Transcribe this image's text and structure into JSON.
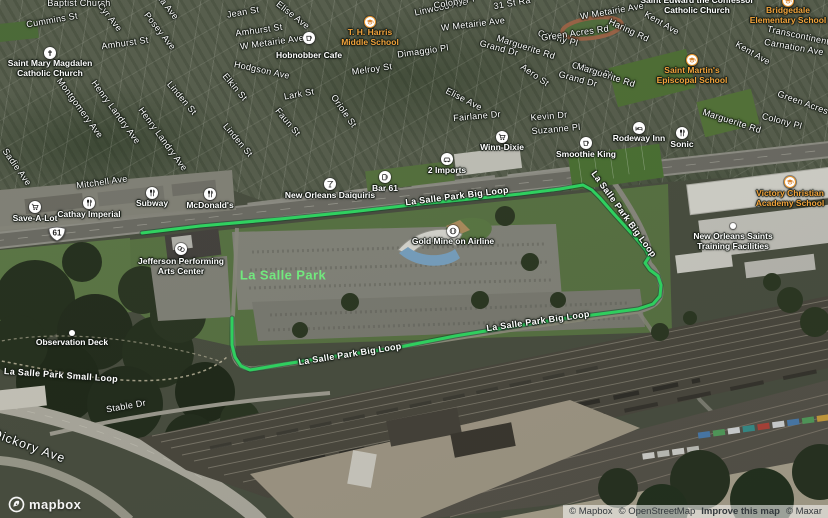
{
  "colors": {
    "route": "#2fe065",
    "park_label": "#72e87e",
    "school_label": "#f2a33c",
    "street_label": "#ffffff"
  },
  "shield": {
    "route_number": "61",
    "x": 57,
    "y": 234
  },
  "park_label": {
    "text": "La Salle Park",
    "x": 283,
    "y": 275
  },
  "logo": {
    "text": "mapbox"
  },
  "attribution": {
    "items": [
      "© Mapbox",
      "© OpenStreetMap",
      "Improve this map",
      "© Maxar"
    ]
  },
  "route": {
    "name": "La Salle Park Big Loop",
    "points": "142,233 200,226 280,219 350,212 420,204 470,199 520,194 560,189 583,185 592,190 600,198 614,214 634,236 646,250 649,257 645,263 650,270 658,276 661,285 660,296 653,304 638,309 600,314 560,319 510,327 455,336 395,348 330,357 285,364 262,368 250,370 241,366 235,357 232,345 232,318"
  },
  "route_labels": [
    {
      "text": "La Salle Park Big Loop",
      "x": 457,
      "y": 196,
      "rot": -7
    },
    {
      "text": "La Salle Park Big Loop",
      "x": 624,
      "y": 214,
      "rot": 54
    },
    {
      "text": "La Salle Park Big Loop",
      "x": 350,
      "y": 354,
      "rot": -9
    },
    {
      "text": "La Salle Park Big Loop",
      "x": 538,
      "y": 321,
      "rot": -8
    },
    {
      "text": "La Salle Park Small Loop",
      "x": 61,
      "y": 375,
      "rot": 4
    }
  ],
  "street_labels": [
    {
      "text": "Baptist Church",
      "x": 79,
      "y": 3,
      "rot": 0
    },
    {
      "text": "Cummins St",
      "x": 52,
      "y": 20,
      "rot": -10
    },
    {
      "text": "ma Ave",
      "x": 167,
      "y": 6,
      "rot": 52
    },
    {
      "text": "Cyr Ave",
      "x": 110,
      "y": 17,
      "rot": 52
    },
    {
      "text": "Posey Ave",
      "x": 160,
      "y": 31,
      "rot": 52
    },
    {
      "text": "Jean St",
      "x": 243,
      "y": 12,
      "rot": -10
    },
    {
      "text": "Amhurst St",
      "x": 125,
      "y": 43,
      "rot": -8
    },
    {
      "text": "Amhurst St",
      "x": 259,
      "y": 30,
      "rot": -8
    },
    {
      "text": "W Metairie Ave",
      "x": 272,
      "y": 42,
      "rot": -8
    },
    {
      "text": "W Metairie Ave",
      "x": 473,
      "y": 24,
      "rot": -7
    },
    {
      "text": "W Metairie Ave",
      "x": 612,
      "y": 11,
      "rot": -10
    },
    {
      "text": "31 St Ra",
      "x": 512,
      "y": 3,
      "rot": -10
    },
    {
      "text": "Elise Ave",
      "x": 293,
      "y": 15,
      "rot": 38
    },
    {
      "text": "Elise Ave",
      "x": 464,
      "y": 99,
      "rot": 27
    },
    {
      "text": "Hodgson Ave",
      "x": 262,
      "y": 70,
      "rot": 12
    },
    {
      "text": "Henry Landry Ave",
      "x": 116,
      "y": 112,
      "rot": 54
    },
    {
      "text": "Henry Landry Ave",
      "x": 163,
      "y": 139,
      "rot": 54
    },
    {
      "text": "Montgomery Ave",
      "x": 80,
      "y": 108,
      "rot": 54
    },
    {
      "text": "Linden St",
      "x": 182,
      "y": 98,
      "rot": 50
    },
    {
      "text": "Linden St",
      "x": 238,
      "y": 140,
      "rot": 50
    },
    {
      "text": "Elkin St",
      "x": 235,
      "y": 87,
      "rot": 50
    },
    {
      "text": "Faun St",
      "x": 288,
      "y": 122,
      "rot": 50
    },
    {
      "text": "Sadie Ave",
      "x": 17,
      "y": 167,
      "rot": 55
    },
    {
      "text": "Mitchell Ave",
      "x": 102,
      "y": 182,
      "rot": -8
    },
    {
      "text": "Lark St",
      "x": 299,
      "y": 94,
      "rot": -10
    },
    {
      "text": "Oriole St",
      "x": 344,
      "y": 111,
      "rot": 55
    },
    {
      "text": "Melroy St",
      "x": 372,
      "y": 69,
      "rot": -8
    },
    {
      "text": "Dimaggio Pl",
      "x": 423,
      "y": 51,
      "rot": -8
    },
    {
      "text": "Linwood Ave",
      "x": 441,
      "y": 7,
      "rot": -12
    },
    {
      "text": "Colony Pl",
      "x": 454,
      "y": 2,
      "rot": -10
    },
    {
      "text": "Colony Pl",
      "x": 558,
      "y": 38,
      "rot": 15
    },
    {
      "text": "Colony Pl",
      "x": 592,
      "y": 70,
      "rot": 15
    },
    {
      "text": "Colony Pl",
      "x": 782,
      "y": 121,
      "rot": 15
    },
    {
      "text": "Marguerite Rd",
      "x": 526,
      "y": 47,
      "rot": 18
    },
    {
      "text": "Marguerite Rd",
      "x": 606,
      "y": 75,
      "rot": 18
    },
    {
      "text": "Marguerite Rd",
      "x": 732,
      "y": 121,
      "rot": 18
    },
    {
      "text": "Grand Dr",
      "x": 499,
      "y": 48,
      "rot": 15
    },
    {
      "text": "Grand Dr",
      "x": 578,
      "y": 79,
      "rot": 15
    },
    {
      "text": "Aero St",
      "x": 535,
      "y": 75,
      "rot": 35
    },
    {
      "text": "Green Acres Rd",
      "x": 575,
      "y": 33,
      "rot": -8
    },
    {
      "text": "Green Acres Rd",
      "x": 810,
      "y": 105,
      "rot": 20
    },
    {
      "text": "Transcontinental",
      "x": 802,
      "y": 36,
      "rot": 12
    },
    {
      "text": "Carnation Ave",
      "x": 794,
      "y": 47,
      "rot": 10
    },
    {
      "text": "Kent Ave",
      "x": 662,
      "y": 23,
      "rot": 30
    },
    {
      "text": "Kent Ave",
      "x": 753,
      "y": 53,
      "rot": 30
    },
    {
      "text": "Haring Rd",
      "x": 629,
      "y": 30,
      "rot": 25
    },
    {
      "text": "Fairlane Dr",
      "x": 477,
      "y": 116,
      "rot": -5
    },
    {
      "text": "Kevin Dr",
      "x": 549,
      "y": 116,
      "rot": -5
    },
    {
      "text": "Suzanne Pl",
      "x": 556,
      "y": 129,
      "rot": -5
    },
    {
      "text": "Stable Dr",
      "x": 126,
      "y": 406,
      "rot": -10
    },
    {
      "text": "Dickory Ave",
      "x": 29,
      "y": 446,
      "rot": 20,
      "big": true
    }
  ],
  "pois": [
    {
      "name": "Save-A-Lot",
      "kind": "white",
      "icon": "cart",
      "x": 35,
      "y": 207,
      "ldy": 7,
      "lines": [
        "Save-A-Lot"
      ]
    },
    {
      "name": "Cathay Imperial",
      "kind": "white",
      "icon": "fork",
      "x": 89,
      "y": 203,
      "ldy": 7,
      "lines": [
        "Cathay Imperial"
      ]
    },
    {
      "name": "Subway",
      "kind": "white",
      "icon": "fork",
      "x": 152,
      "y": 193,
      "ldy": 6,
      "lines": [
        "Subway"
      ]
    },
    {
      "name": "McDonald's",
      "kind": "white",
      "icon": "fork",
      "x": 210,
      "y": 194,
      "ldy": 7,
      "lines": [
        "McDonald's"
      ]
    },
    {
      "name": "New Orleans Daiquiris",
      "kind": "white",
      "icon": "cocktail",
      "x": 330,
      "y": 184,
      "ldy": 7,
      "lines": [
        "New Orleans Daiquiris"
      ]
    },
    {
      "name": "Bar 61",
      "kind": "white",
      "icon": "beer",
      "x": 385,
      "y": 177,
      "ldy": 7,
      "lines": [
        "Bar 61"
      ]
    },
    {
      "name": "Gold Mine on Airline",
      "kind": "white",
      "icon": "ball",
      "x": 453,
      "y": 231,
      "ldy": 6,
      "lines": [
        "Gold Mine on Airline"
      ]
    },
    {
      "name": "Jefferson Performing Arts Center",
      "kind": "white",
      "icon": "masks",
      "x": 181,
      "y": 249,
      "ldy": 8,
      "lines": [
        "Jefferson Performing",
        "Arts Center"
      ]
    },
    {
      "name": "Winn-Dixie",
      "kind": "white",
      "icon": "cart",
      "x": 502,
      "y": 137,
      "ldy": 6,
      "lines": [
        "Winn-Dixie"
      ]
    },
    {
      "name": "2 Imports",
      "kind": "white",
      "icon": "car",
      "x": 447,
      "y": 159,
      "ldy": 7,
      "lines": [
        "2 Imports"
      ]
    },
    {
      "name": "Smoothie King",
      "kind": "white",
      "icon": "cup",
      "x": 586,
      "y": 143,
      "ldy": 7,
      "lines": [
        "Smoothie King"
      ]
    },
    {
      "name": "Rodeway Inn",
      "kind": "white",
      "icon": "bed",
      "x": 639,
      "y": 128,
      "ldy": 6,
      "lines": [
        "Rodeway Inn"
      ]
    },
    {
      "name": "Sonic",
      "kind": "white",
      "icon": "fork",
      "x": 682,
      "y": 133,
      "ldy": 7,
      "lines": [
        "Sonic"
      ]
    },
    {
      "name": "Hobnobber Cafe",
      "kind": "white",
      "icon": "cup",
      "x": 309,
      "y": 38,
      "ldy": 13,
      "lines": [
        "Hobnobber Cafe"
      ]
    },
    {
      "name": "Saint Mary Magdalen Catholic Church",
      "kind": "white",
      "icon": "cross",
      "x": 50,
      "y": 53,
      "ldy": 6,
      "lines": [
        "Saint Mary Magdalen",
        "Catholic Church"
      ]
    },
    {
      "name": "T. H. Harris Middle School",
      "kind": "school",
      "icon": "cap",
      "x": 370,
      "y": 22,
      "ldy": 6,
      "lines": [
        "T. H. Harris",
        "Middle School"
      ]
    },
    {
      "name": "Saint Edward the Confessor Catholic Church",
      "kind": "text",
      "icon": "",
      "x": 697,
      "y": 0,
      "ldy": -4,
      "lines": [
        "Saint Edward the Confessor",
        "Catholic Church"
      ]
    },
    {
      "name": "Bridgedale Elementary School",
      "kind": "school",
      "icon": "cap",
      "x": 788,
      "y": 1,
      "ldy": 5,
      "lines": [
        "Bridgedale",
        "Elementary School"
      ]
    },
    {
      "name": "Saint Martin's Episcopal School",
      "kind": "school",
      "icon": "cap",
      "x": 692,
      "y": 60,
      "ldy": 6,
      "lines": [
        "Saint Martin's",
        "Episcopal School"
      ]
    },
    {
      "name": "Victory Christian Academy School",
      "kind": "school",
      "icon": "cap",
      "x": 790,
      "y": 182,
      "ldy": 7,
      "lines": [
        "Victory Christian",
        "Academy School"
      ]
    },
    {
      "name": "New Orleans Saints Training Facilities",
      "kind": "dot",
      "icon": "",
      "x": 733,
      "y": 226,
      "ldy": 6,
      "lines": [
        "New Orleans Saints",
        "Training Facilities"
      ]
    },
    {
      "name": "Observation Deck",
      "kind": "dot",
      "icon": "",
      "x": 72,
      "y": 333,
      "ldy": 5,
      "lines": [
        "Observation Deck"
      ]
    }
  ]
}
